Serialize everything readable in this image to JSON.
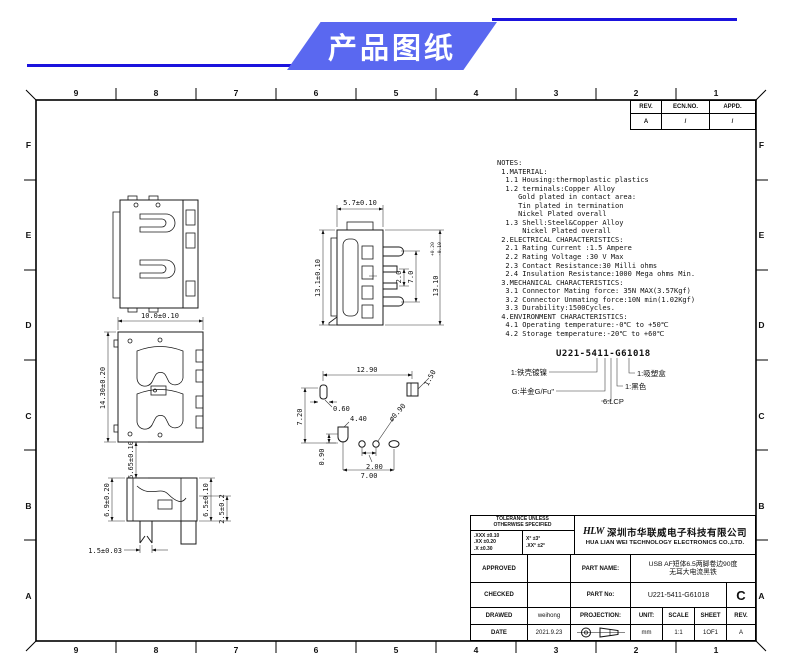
{
  "banner": {
    "title": "产品图纸",
    "bg_color": "#5a68f0",
    "line_color": "#1b13dd"
  },
  "grid": {
    "columns": [
      "9",
      "8",
      "7",
      "6",
      "5",
      "4",
      "3",
      "2",
      "1"
    ],
    "rows": [
      "F",
      "E",
      "D",
      "C",
      "B",
      "A"
    ]
  },
  "ecn_table": {
    "rev_header": "REV.",
    "ecn_header": "ECN.NO.",
    "appd_header": "APPD.",
    "rev_value": "A",
    "ecn_value": "/",
    "appd_value": "/"
  },
  "notes": {
    "text": "NOTES:\n 1.MATERIAL:\n  1.1 Housing:thermoplastic plastics\n  1.2 terminals:Copper Alloy\n     Gold plated in contact area:\n     Tin plated in termination\n     Nickel Plated overall\n  1.3 Shell:Steel&Copper Alloy\n      Nickel Plated overall\n 2.ELECTRICAL CHARACTERISTICS:\n  2.1 Rating Current :1.5 Ampere\n  2.2 Rating Voltage :30 V Max\n  2.3 Contact Resistance:30 Milli ohms\n  2.4 Insulation Resistance:1000 Mega ohms Min.\n 3.MECHANICAL CHARACTERISTICS:\n  3.1 Connector Mating force: 35N MAX(3.57Kgf)\n  3.2 Connector Unmating force:10N min(1.02Kgf)\n  3.3 Durability:1500Cycles.\n 4.ENVIRONMENT CHARACTERISTICS:\n  4.1 Operating temperature:-0℃ to +50℃\n  4.2 Storage temperature:-20℃ to +60℃"
  },
  "part_code": {
    "code": "U221-5411-G61018",
    "callout_shell": "1:铁壳镀镍",
    "callout_plating": "G:半金G/Fu\"",
    "callout_material": "6:LCP",
    "callout_color": "1:黑色",
    "callout_packing": "1:吸塑盒"
  },
  "dims": {
    "front_width": "5.7±0.10",
    "front_height": "13.1±0.10",
    "pin_pitch": "2.0",
    "pin_span": "7.0",
    "front_height_right": "13.10",
    "front_height_right_plus": "+0.20",
    "front_height_right_minus": "-0.10",
    "top_width": "10.0±0.10",
    "top_height": "14.30±0.20",
    "gap": "6.65±0.10",
    "side_h1": "6.9±0.20",
    "side_h2": "6.5±0.10",
    "side_h3": "2.5±0.2",
    "leg_w": "1.5±0.03",
    "fp_span": "12.90",
    "fp_slot": "1.50",
    "fp_slot_w": "0.60",
    "fp_v": "7.20",
    "fp_mid": "4.40",
    "fp_hole": "ø0.90",
    "fp_h2": "0.90",
    "fp_pitch": "2.00",
    "fp_row": "7.00"
  },
  "title_block": {
    "tolerance_header_l1": "TOLERANCE UNLESS",
    "tolerance_header_l2": "OTHERWISE SPECIFIED",
    "tolerance_left": [
      ".XXX ±0.10",
      ".XX  ±0.20",
      ".X   ±0.30"
    ],
    "tolerance_right": [
      "X°  ±3°",
      ".XX° ±2°"
    ],
    "logo": "HLW",
    "company_cn": "深圳市华联威电子科技有限公司",
    "company_en": "HUA LIAN WEI TECHNOLOGY ELECTRONICS CO.,LTD.",
    "approved_label": "APPROVED",
    "checked_label": "CHECKED",
    "drawed_label": "DRAWED",
    "date_label": "DATE",
    "drawed_value": "weihong",
    "date_value": "2021.9.23",
    "part_name_label": "PART NAME:",
    "part_name_l1": "USB AF短体6.5两脚卷边90度",
    "part_name_l2": "无耳大电流黑铁",
    "part_no_label": "PART No:",
    "part_no_value": "U221-5411-G61018",
    "rev_letter": "C",
    "projection_label": "PROJECTION:",
    "unit_label": "UNIT:",
    "unit_value": "mm",
    "scale_label": "SCALE",
    "scale_value": "1:1",
    "sheet_label": "SHEET",
    "sheet_value": "1OF1",
    "rev_label": "REV.",
    "rev_value": "A"
  }
}
